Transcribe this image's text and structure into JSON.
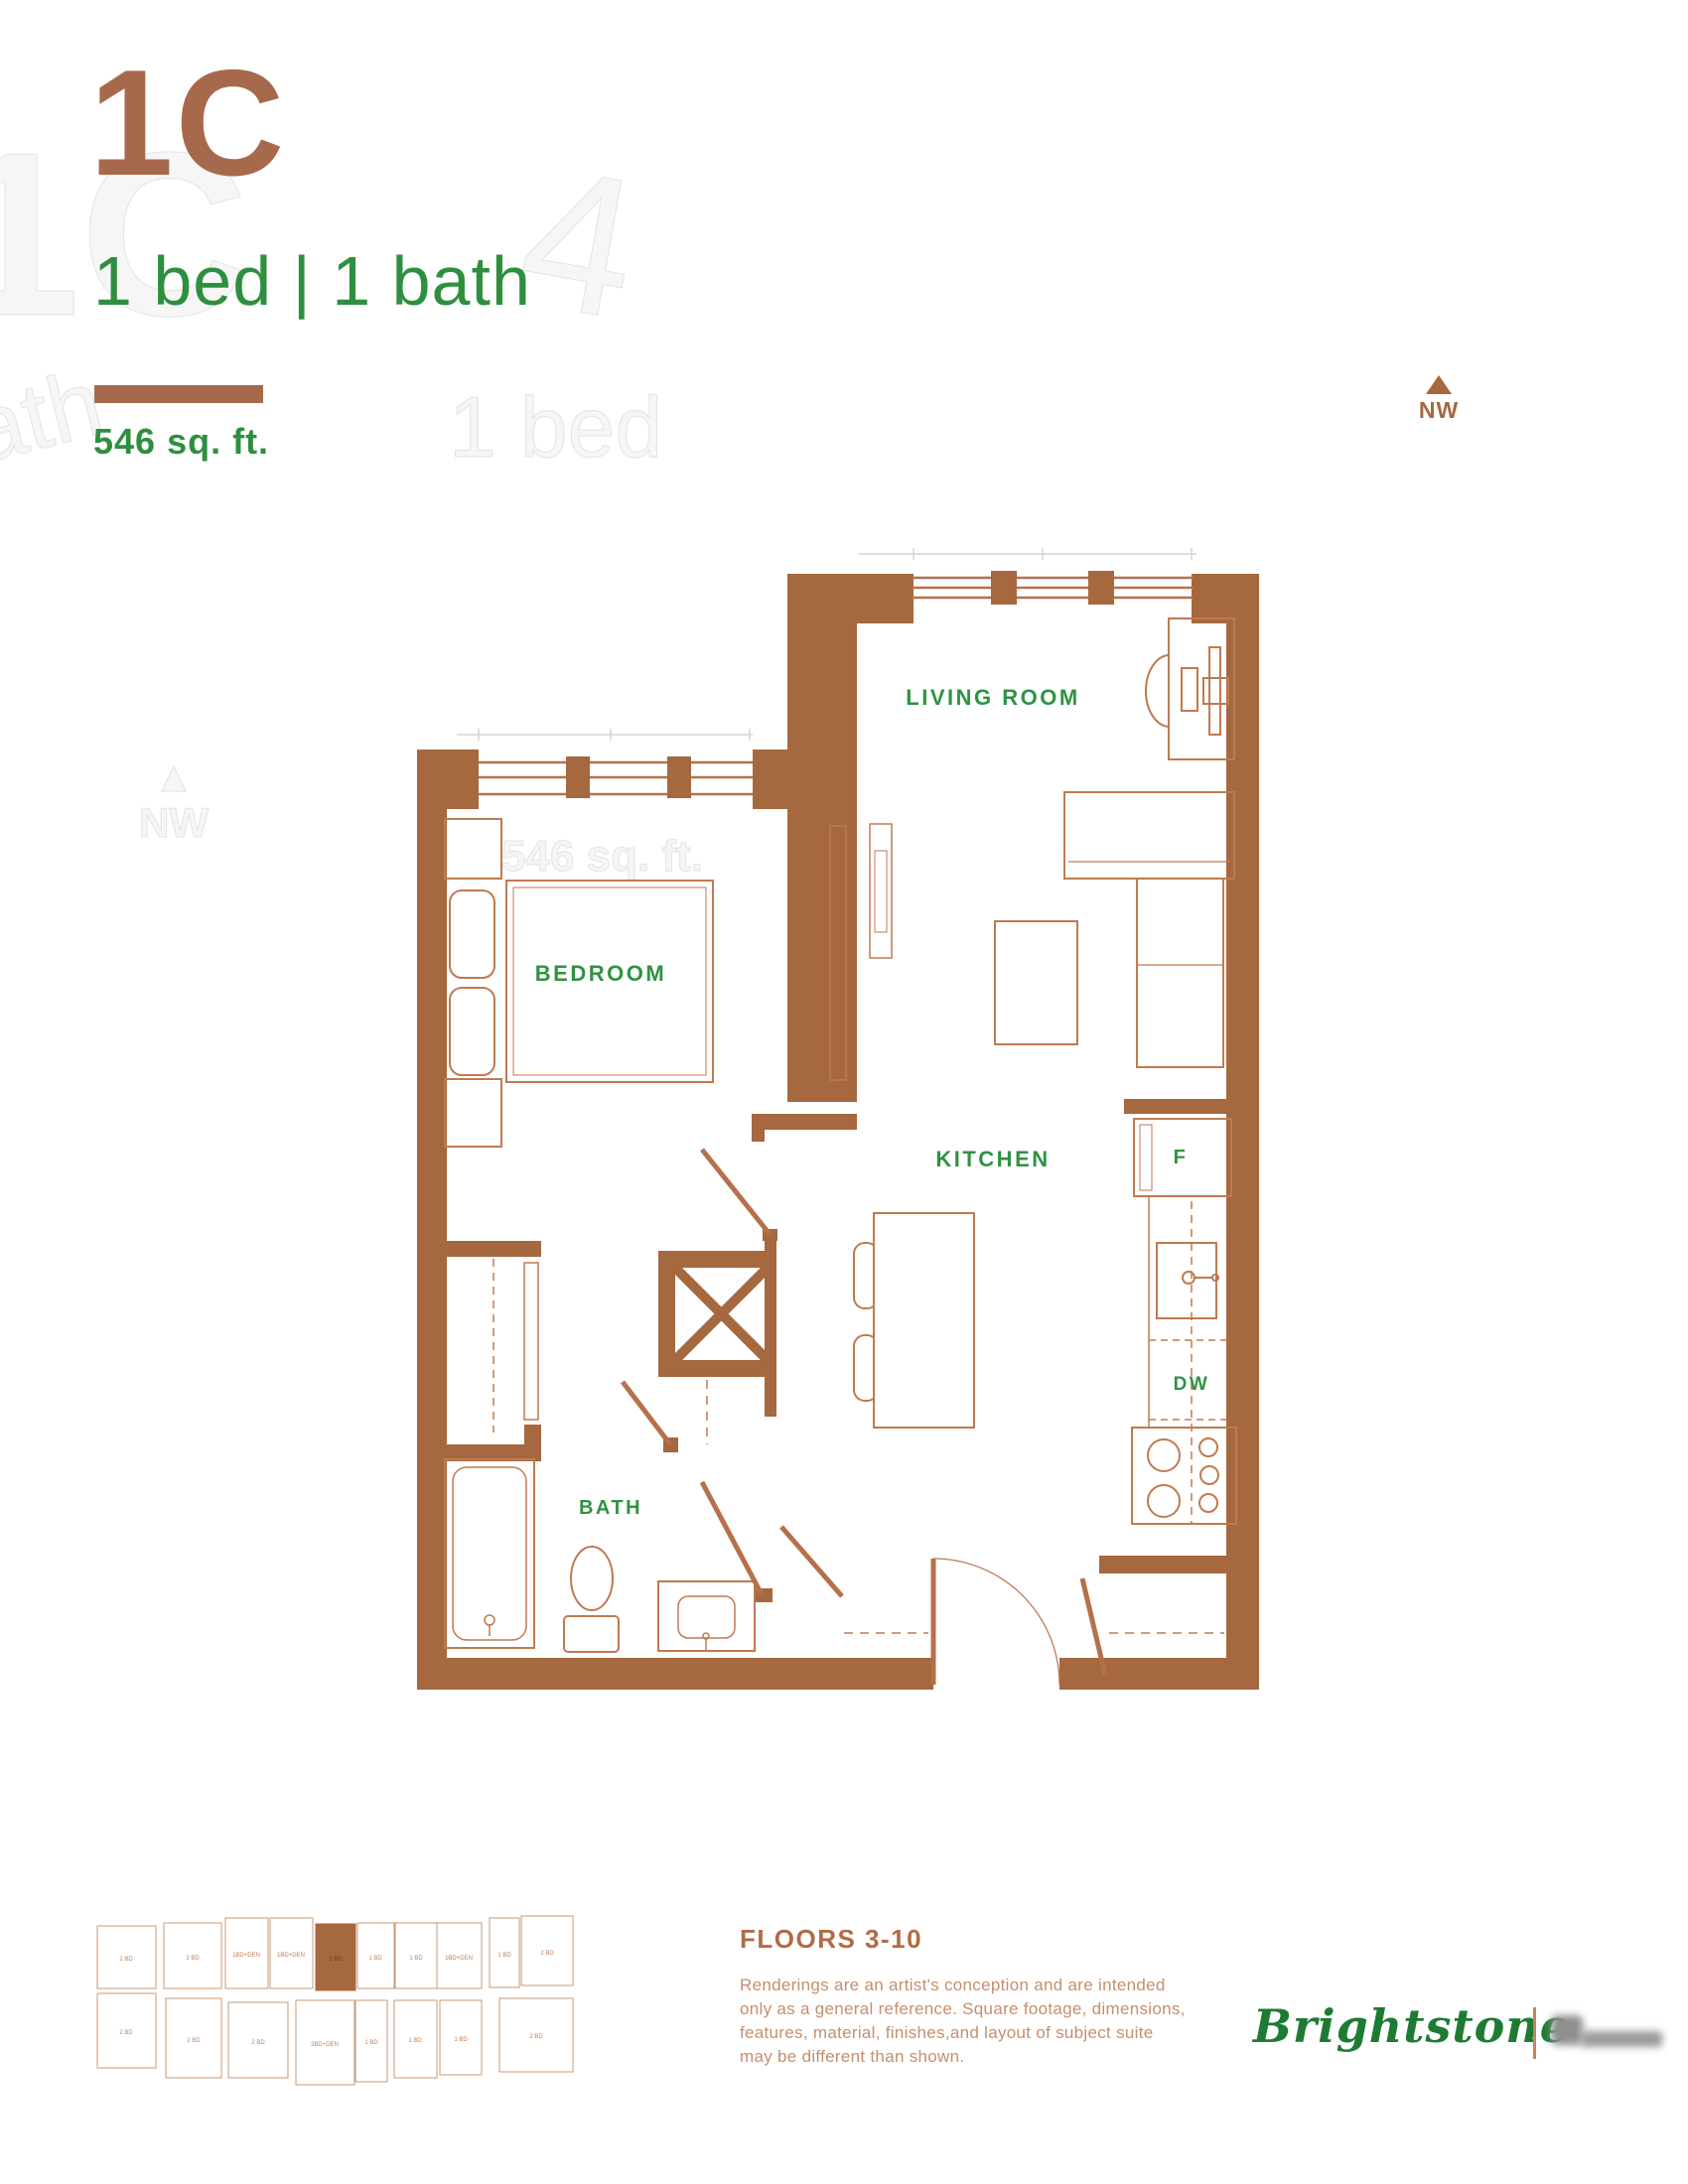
{
  "header": {
    "unit_code": "1C",
    "spec": "1 bed | 1 bath",
    "area": "546 sq. ft."
  },
  "compass": {
    "direction": "NW"
  },
  "plan": {
    "labels": {
      "living": "LIVING ROOM",
      "bedroom": "BEDROOM",
      "kitchen": "KITCHEN",
      "bath": "BATH",
      "fridge": "F",
      "dishwasher": "DW"
    }
  },
  "watermarks": {
    "unit": "1C",
    "spec": "1 bed | 1 bath",
    "bed": "1 bed",
    "digit": "4",
    "compass_arrow": "▲",
    "compass": "NW",
    "area": "546 sq. ft."
  },
  "keyplan": {
    "units": [
      "2 BD",
      "2 BD",
      "1BD+DEN",
      "1BD+DEN",
      "1 BD",
      "1 BD",
      "1 BD",
      "1BD+DEN",
      "1 BD",
      "2 BD",
      "2 BD",
      "2 BD",
      "2 BD",
      "2BD+DEN",
      "1 BD",
      "1 BD",
      "1 BD",
      "2 BD"
    ],
    "highlight_index": 4
  },
  "footer": {
    "floors": "FLOORS 3-10",
    "disclaimer_lines": [
      "Renderings are an artist's conception and are intended",
      "only as a general reference. Square footage, dimensions,",
      "features, material, finishes,and layout of subject suite",
      "may be different than shown."
    ],
    "brand": "Brightstone"
  },
  "colors": {
    "wall_brown": "#a5683f",
    "furniture_line": "#c07a50",
    "label_green": "#2f9243",
    "title_brown": "#a7694b",
    "footer_brown": "#b26b46",
    "brand_green": "#1e7b33"
  }
}
